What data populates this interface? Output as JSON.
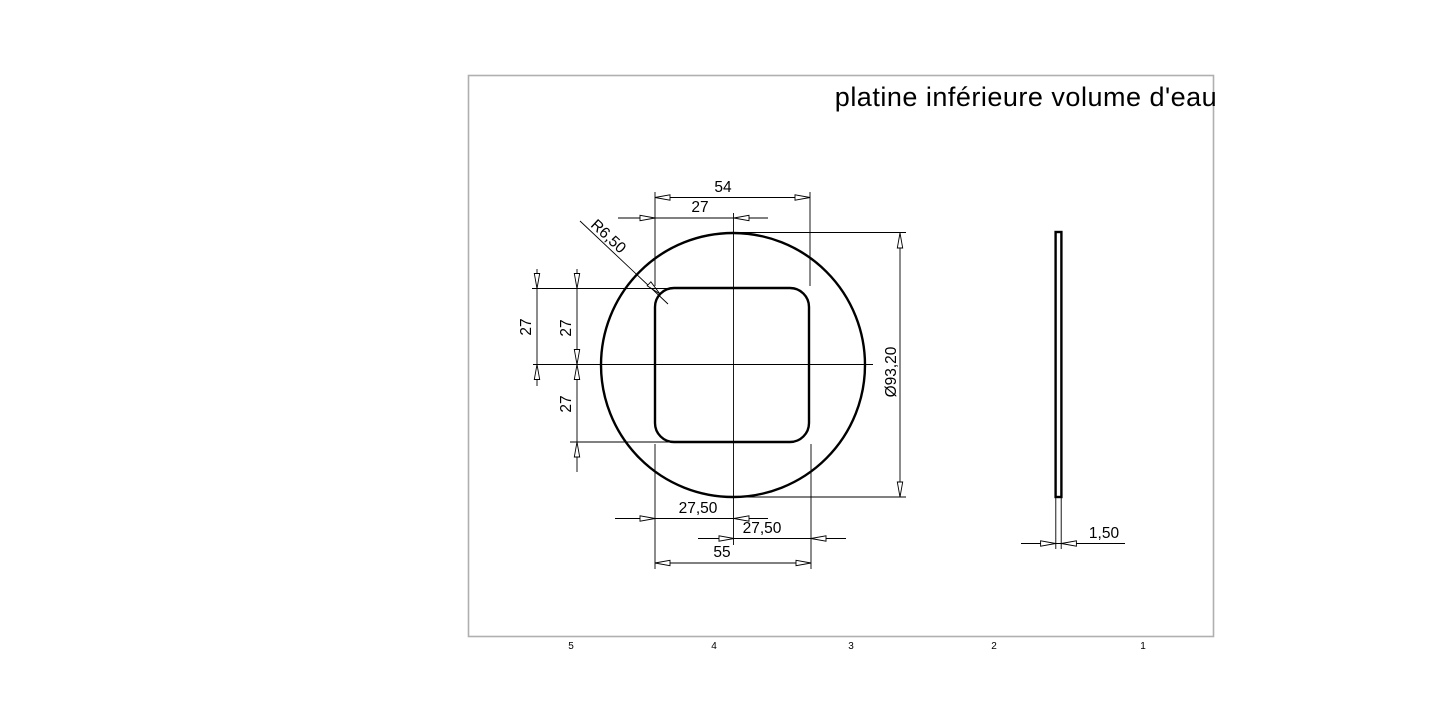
{
  "title": "platine inférieure volume d'eau",
  "dims": {
    "top_width": "54",
    "top_center": "27",
    "corner_radius": "R6,50",
    "left_offset": "27",
    "left_upper": "27",
    "left_lower": "27",
    "diameter": "Ø93,20",
    "bottom_left_half": "27,50",
    "bottom_right_half": "27,50",
    "bottom_width": "55",
    "thickness": "1,50"
  },
  "zones": [
    "5",
    "4",
    "3",
    "2",
    "1"
  ]
}
